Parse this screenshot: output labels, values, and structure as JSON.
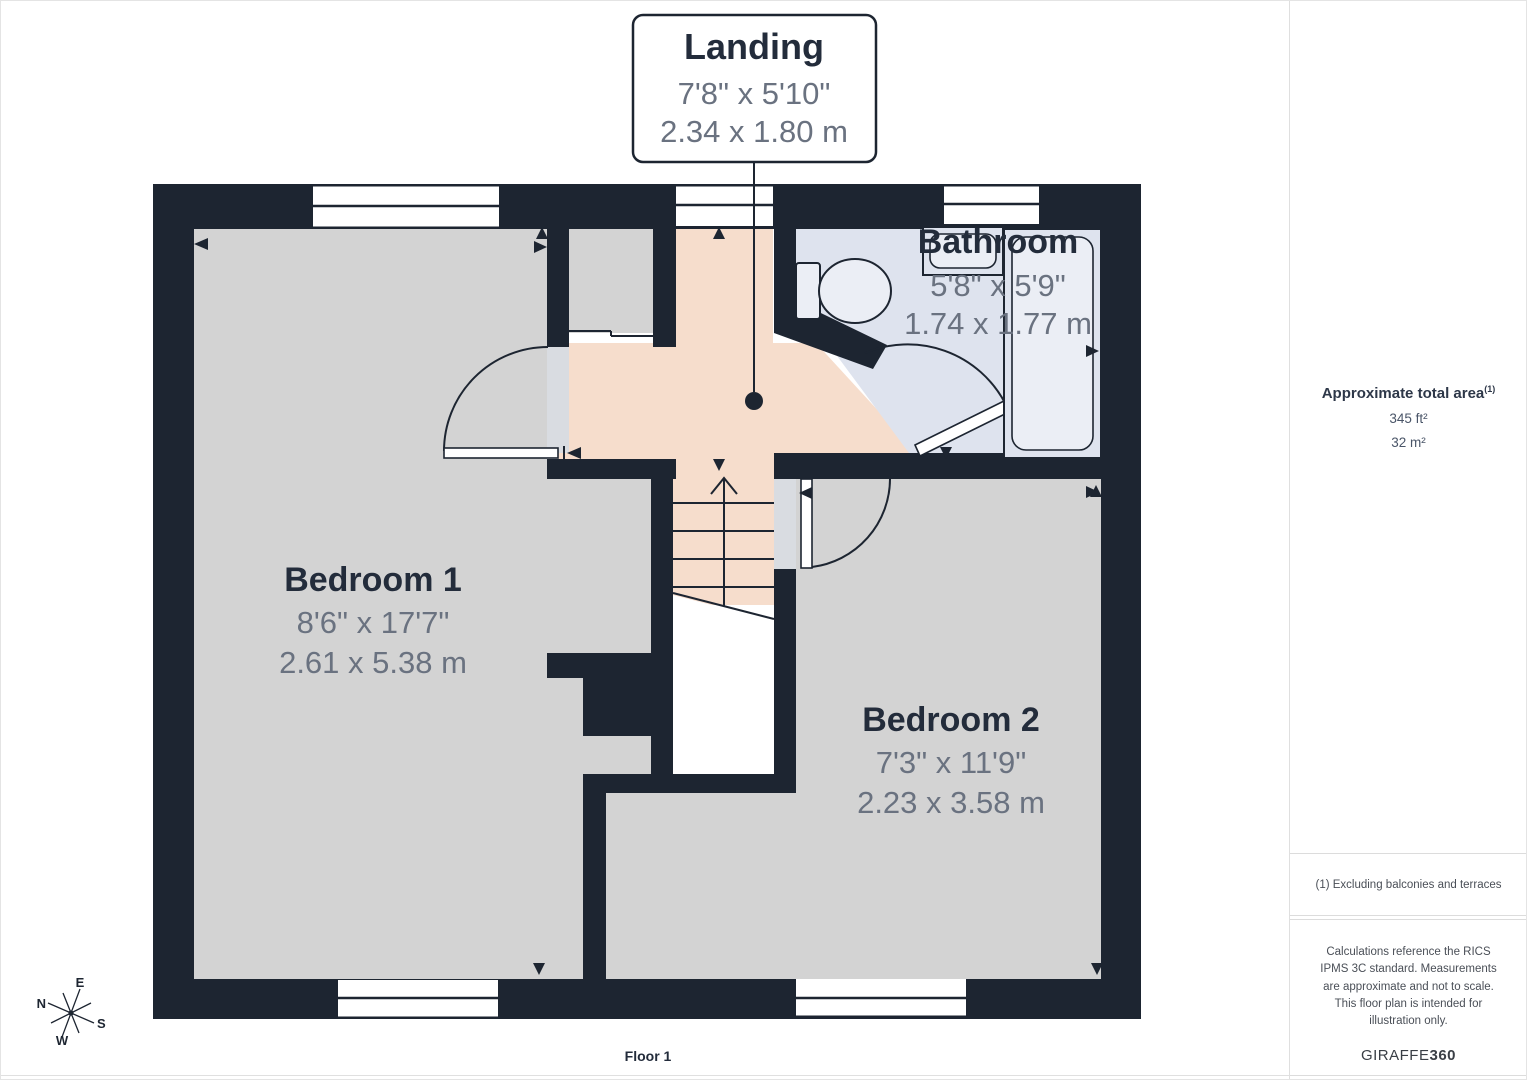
{
  "callout": {
    "title": "Landing",
    "imperial": "7'8\" x 5'10\"",
    "metric": "2.34 x 1.80 m"
  },
  "rooms": {
    "bedroom1": {
      "name": "Bedroom 1",
      "imperial": "8'6\" x 17'7\"",
      "metric": "2.61 x 5.38 m"
    },
    "bedroom2": {
      "name": "Bedroom 2",
      "imperial": "7'3\" x 11'9\"",
      "metric": "2.23 x 3.58 m"
    },
    "bathroom": {
      "name": "Bathroom",
      "imperial": "5'8\" x 5'9\"",
      "metric": "1.74 x 1.77 m"
    }
  },
  "floor_label": "Floor 1",
  "compass": {
    "n": "N",
    "e": "E",
    "s": "S",
    "w": "W"
  },
  "sidebar": {
    "area_title": "Approximate total area",
    "area_superscript": "(1)",
    "area_ft": "345 ft²",
    "area_m": "32 m²",
    "footnote": "(1) Excluding balconies and terraces",
    "disclaimer": "Calculations reference the RICS IPMS 3C standard. Measurements are approximate and not to scale. This floor plan is intended for illustration only.",
    "brand_regular": "GIRAFFE",
    "brand_bold": "360"
  },
  "colors": {
    "wall": "#1d2531",
    "bedroom_floor": "#d3d3d3",
    "landing_floor": "#f6ddcc",
    "bathroom_floor": "#dee3ee",
    "fixture_fill": "#ebeef5",
    "threshold": "#d9dce1",
    "label_dark": "#232c3b",
    "dim_gray": "#6a7280"
  }
}
